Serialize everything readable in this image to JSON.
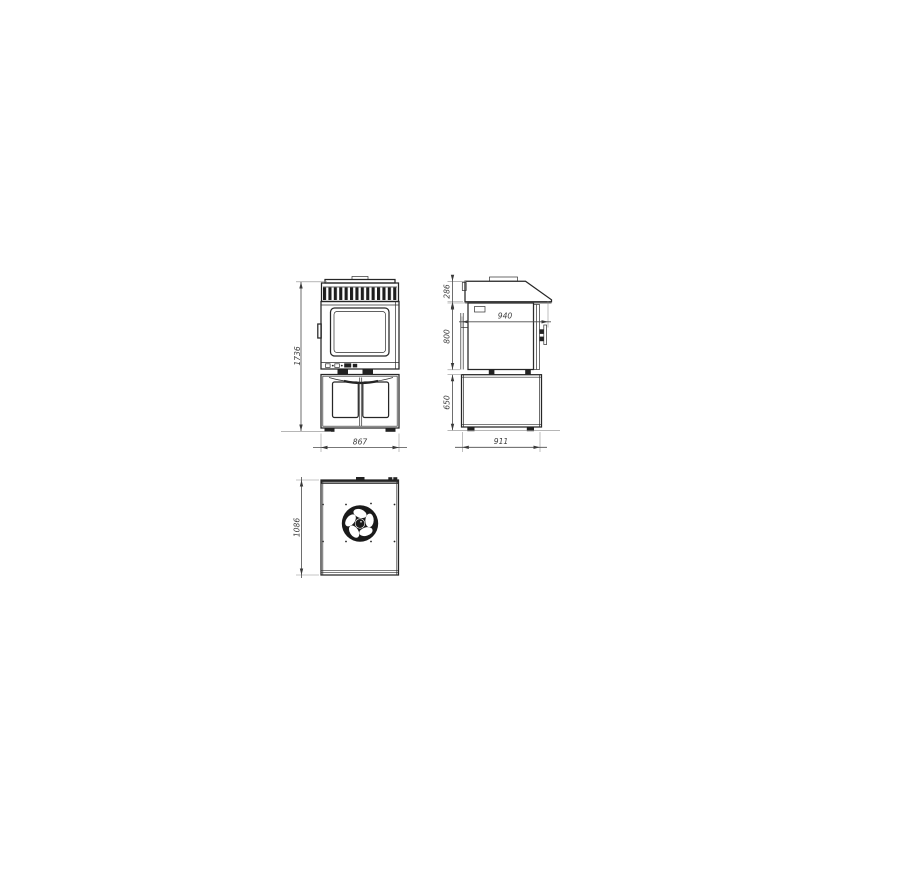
{
  "drawing": {
    "front": {
      "height": "1736",
      "width": "867"
    },
    "side": {
      "hood_height": "286",
      "depth": "940",
      "body_height": "800",
      "base_height": "650",
      "base_depth": "911"
    },
    "rear": {
      "height": "1086"
    }
  },
  "colors": {
    "line": "#262626",
    "dimension": "#4a4a4a",
    "label_text": "#3d3d3d",
    "background": "#ffffff"
  }
}
